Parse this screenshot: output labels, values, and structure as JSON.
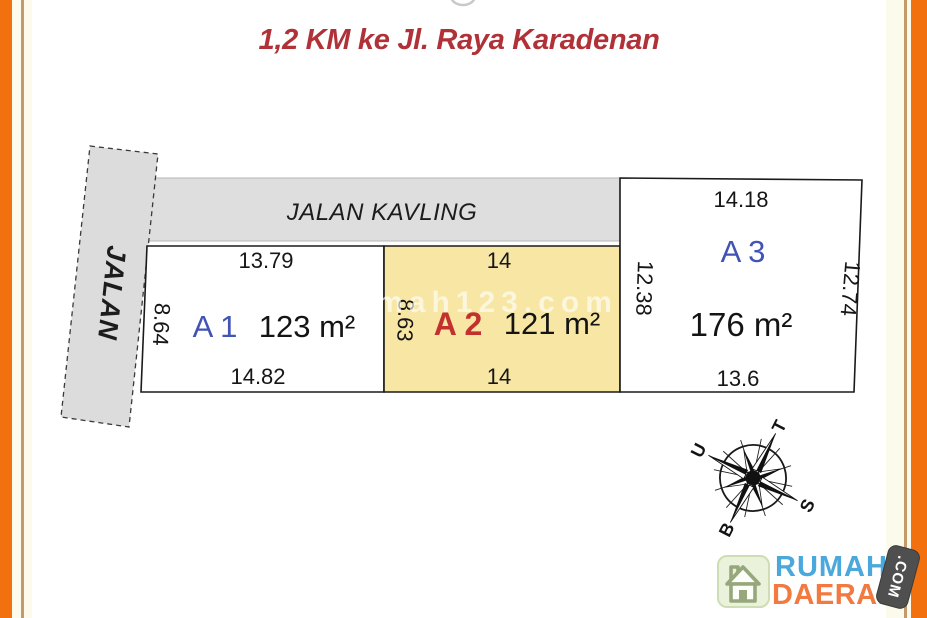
{
  "title": {
    "text": "1,2 KM ke Jl. Raya Karadenan"
  },
  "watermark": {
    "text": "rumah123.com"
  },
  "roads": {
    "vertical_label": "JALAN",
    "horizontal_label": "JALAN KAVLING"
  },
  "plots": {
    "a1": {
      "label": "A 1",
      "area": "123 m²",
      "dim_top": "13.79",
      "dim_left": "8.64",
      "dim_bottom": "14.82"
    },
    "a2": {
      "label": "A 2",
      "area": "121 m²",
      "dim_top": "14",
      "dim_left": "8.63",
      "dim_bottom": "14"
    },
    "a3": {
      "label": "A 3",
      "area": "176 m²",
      "dim_top": "14.18",
      "dim_left": "12.38",
      "dim_right": "12.74",
      "dim_bottom": "13.6"
    }
  },
  "compass": {
    "north": "U",
    "east": "T",
    "south": "S",
    "west": "B"
  },
  "logo": {
    "name_top": "RUMAH",
    "name_bottom": "DAERAH",
    "badge": ".COM"
  },
  "colors": {
    "frame_orange": "#F2700D",
    "frame_tan": "#C49A6C",
    "frame_cream": "#FCFAEB",
    "road_gray": "#DEDEDE",
    "plot_highlight": "#F7E6A4",
    "label_blue": "#4153B5",
    "label_red": "#C2312E",
    "title_red": "#B03238",
    "logo_blue": "#4BA8DC",
    "logo_orange": "#F2793F",
    "logo_tile_green": "#EBF2DB"
  }
}
